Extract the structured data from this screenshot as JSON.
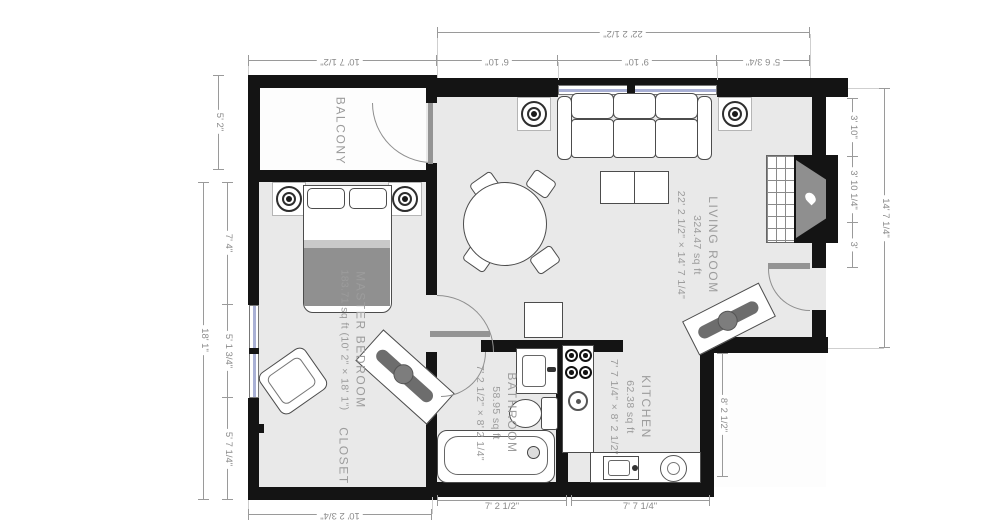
{
  "plan": {
    "title": "apartment-floor-plan",
    "rooms": {
      "balcony": {
        "name": "BALCONY"
      },
      "master_bedroom": {
        "name": "MASTER BEDROOM",
        "area": "183.71 sq ft (10' 2\" × 18' 1\")"
      },
      "closet": {
        "name": "CLOSET"
      },
      "living_room": {
        "name": "LIVING ROOM",
        "area": "324.47 sq ft",
        "size": "22' 2 1/2\" × 14' 7 1/4\""
      },
      "bathroom": {
        "name": "BATHROOM",
        "area": "58.95 sq ft",
        "size": "7' 2 1/2\" × 8' 2 1/4\""
      },
      "kitchen": {
        "name": "KITCHEN",
        "area": "62.38 sq ft",
        "size": "7' 7 1/4\" × 8' 2 1/2\""
      }
    },
    "dimensions": {
      "top_balcony": "10' 7 1/2\"",
      "top_overall": "22' 2 1/2\"",
      "top_seg1": "6' 10\"",
      "top_seg2": "9' 10\"",
      "top_seg3": "5' 6 3/4\"",
      "left_balcony": "5' 2\"",
      "left_overall": "18' 1\"",
      "left_seg1": "7' 4\"",
      "left_seg2": "5' 1 3/4\"",
      "left_seg3": "5' 7 1/4\"",
      "right_seg1": "3' 10\"",
      "right_seg2": "3' 10 1/4\"",
      "right_seg3": "3'",
      "right_overall": "14' 7 1/4\"",
      "right_kitchen": "8' 2 1/2\"",
      "bottom_closet": "10' 2 3/4\"",
      "bottom_bathroom": "7' 2 1/2\"",
      "bottom_kitchen": "7' 7 1/4\""
    },
    "colors": {
      "wall": "#141414",
      "floor": "#e9e9e9",
      "balcony_floor": "#fdfdfd",
      "window_glass": "#a9b0d5",
      "dimension": "#8a8a8a",
      "room_label": "#9c9c9c",
      "blanket": "#909090"
    },
    "fixtures": [
      "ceiling-light",
      "bed",
      "bench",
      "armchair",
      "sofa",
      "coffee-table",
      "dining-table",
      "fireplace",
      "cabinet",
      "vanity-sink",
      "toilet",
      "bathtub",
      "stove",
      "kitchen-sink",
      "counter"
    ]
  }
}
